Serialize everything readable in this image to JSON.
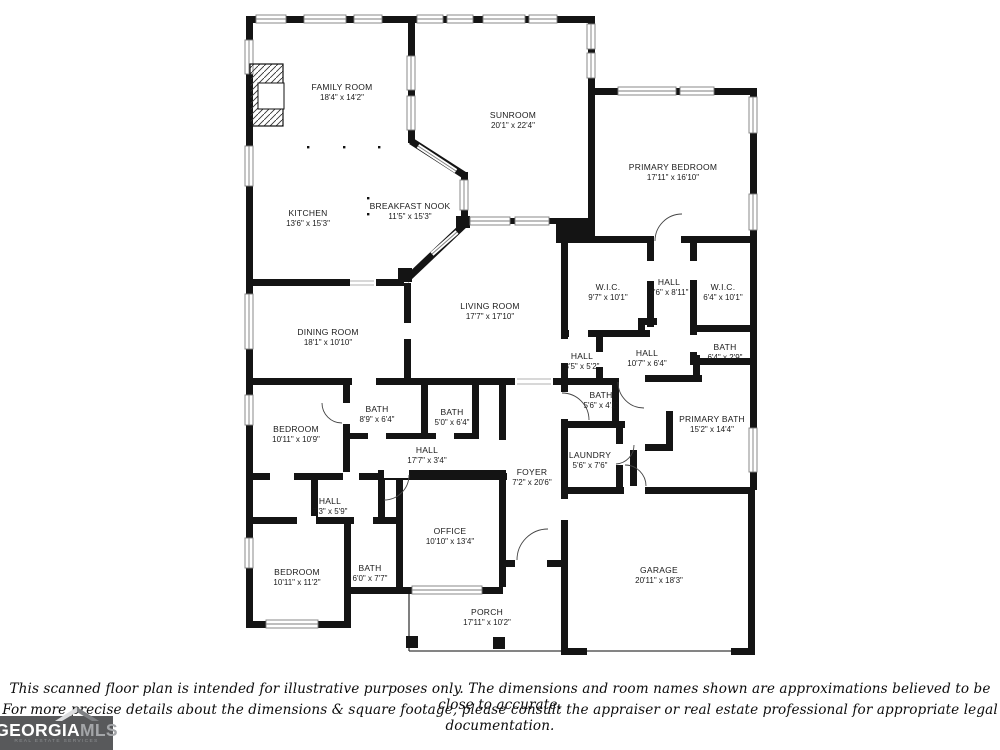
{
  "floorplan": {
    "rooms": [
      {
        "id": "family-room",
        "name": "FAMILY ROOM",
        "dims": "18'4\" x 14'2\"",
        "cx": 342,
        "cy": 92
      },
      {
        "id": "sunroom",
        "name": "SUNROOM",
        "dims": "20'1\" x 22'4\"",
        "cx": 513,
        "cy": 120
      },
      {
        "id": "primary-bedroom",
        "name": "PRIMARY BEDROOM",
        "dims": "17'11\" x 16'10\"",
        "cx": 673,
        "cy": 172
      },
      {
        "id": "kitchen",
        "name": "KITCHEN",
        "dims": "13'6\" x 15'3\"",
        "cx": 308,
        "cy": 218
      },
      {
        "id": "breakfast-nook",
        "name": "BREAKFAST NOOK",
        "dims": "11'5\" x 15'3\"",
        "cx": 410,
        "cy": 211
      },
      {
        "id": "wic-left",
        "name": "W.I.C.",
        "dims": "9'7\" x 10'1\"",
        "cx": 608,
        "cy": 292
      },
      {
        "id": "hall-upper",
        "name": "HALL",
        "dims": "4'6\" x 8'11\"",
        "cx": 669,
        "cy": 287
      },
      {
        "id": "wic-right",
        "name": "W.I.C.",
        "dims": "6'4\" x 10'1\"",
        "cx": 723,
        "cy": 292
      },
      {
        "id": "dining-room",
        "name": "DINING ROOM",
        "dims": "18'1\" x 10'10\"",
        "cx": 328,
        "cy": 337
      },
      {
        "id": "living-room",
        "name": "LIVING ROOM",
        "dims": "17'7\" x 17'10\"",
        "cx": 490,
        "cy": 311
      },
      {
        "id": "hall-small",
        "name": "HALL",
        "dims": "3'5\" x 5'2\"",
        "cx": 582,
        "cy": 361
      },
      {
        "id": "hall-mid",
        "name": "HALL",
        "dims": "10'7\" x 6'4\"",
        "cx": 647,
        "cy": 358
      },
      {
        "id": "bath-small-right",
        "name": "BATH",
        "dims": "6'4\" x 2'9\"",
        "cx": 725,
        "cy": 352
      },
      {
        "id": "bath-left",
        "name": "BATH",
        "dims": "8'9\" x 6'4\"",
        "cx": 377,
        "cy": 414
      },
      {
        "id": "bath-mid",
        "name": "BATH",
        "dims": "5'0\" x 6'4\"",
        "cx": 452,
        "cy": 417
      },
      {
        "id": "bath-hall",
        "name": "BATH",
        "dims": "5'6\" x 4'1\"",
        "cx": 601,
        "cy": 400
      },
      {
        "id": "primary-bath",
        "name": "PRIMARY BATH",
        "dims": "15'2\" x 14'4\"",
        "cx": 712,
        "cy": 424
      },
      {
        "id": "bedroom-upper",
        "name": "BEDROOM",
        "dims": "10'11\" x 10'9\"",
        "cx": 296,
        "cy": 434
      },
      {
        "id": "hall-long",
        "name": "HALL",
        "dims": "17'7\" x 3'4\"",
        "cx": 427,
        "cy": 455
      },
      {
        "id": "laundry",
        "name": "LAUNDRY",
        "dims": "5'6\" x 7'6\"",
        "cx": 590,
        "cy": 460
      },
      {
        "id": "foyer",
        "name": "FOYER",
        "dims": "7'2\" x 20'6\"",
        "cx": 532,
        "cy": 477
      },
      {
        "id": "hall-lower",
        "name": "HALL",
        "dims": "7'3\" x 5'9\"",
        "cx": 330,
        "cy": 506
      },
      {
        "id": "office",
        "name": "OFFICE",
        "dims": "10'10\" x 13'4\"",
        "cx": 450,
        "cy": 536
      },
      {
        "id": "bedroom-lower",
        "name": "BEDROOM",
        "dims": "10'11\" x 11'2\"",
        "cx": 297,
        "cy": 577
      },
      {
        "id": "bath-lower",
        "name": "BATH",
        "dims": "6'0\" x 7'7\"",
        "cx": 370,
        "cy": 573
      },
      {
        "id": "garage",
        "name": "GARAGE",
        "dims": "20'11\" x 18'3\"",
        "cx": 659,
        "cy": 575
      },
      {
        "id": "porch",
        "name": "PORCH",
        "dims": "17'11\" x 10'2\"",
        "cx": 487,
        "cy": 617
      }
    ]
  },
  "footer": {
    "disclaimer_line1": "This scanned floor plan is intended for illustrative purposes only. The dimensions and room names shown are approximations believed to be close to accurate.",
    "disclaimer_line2": "For more precise details about the dimensions & square footage, please consult the appraiser or real estate professional for appropriate legal documentation."
  },
  "logo": {
    "brand_primary": "GEORGIA",
    "brand_secondary": "MLS",
    "tagline": "REAL ESTATE SERVICES"
  },
  "colors": {
    "wall": "#141414",
    "window_line": "#7d7d7d",
    "logo_bg": "#58595b",
    "logo_primary": "#ffffff",
    "logo_secondary": "#a4a6a9",
    "logo_tagline": "#8d8f92"
  }
}
